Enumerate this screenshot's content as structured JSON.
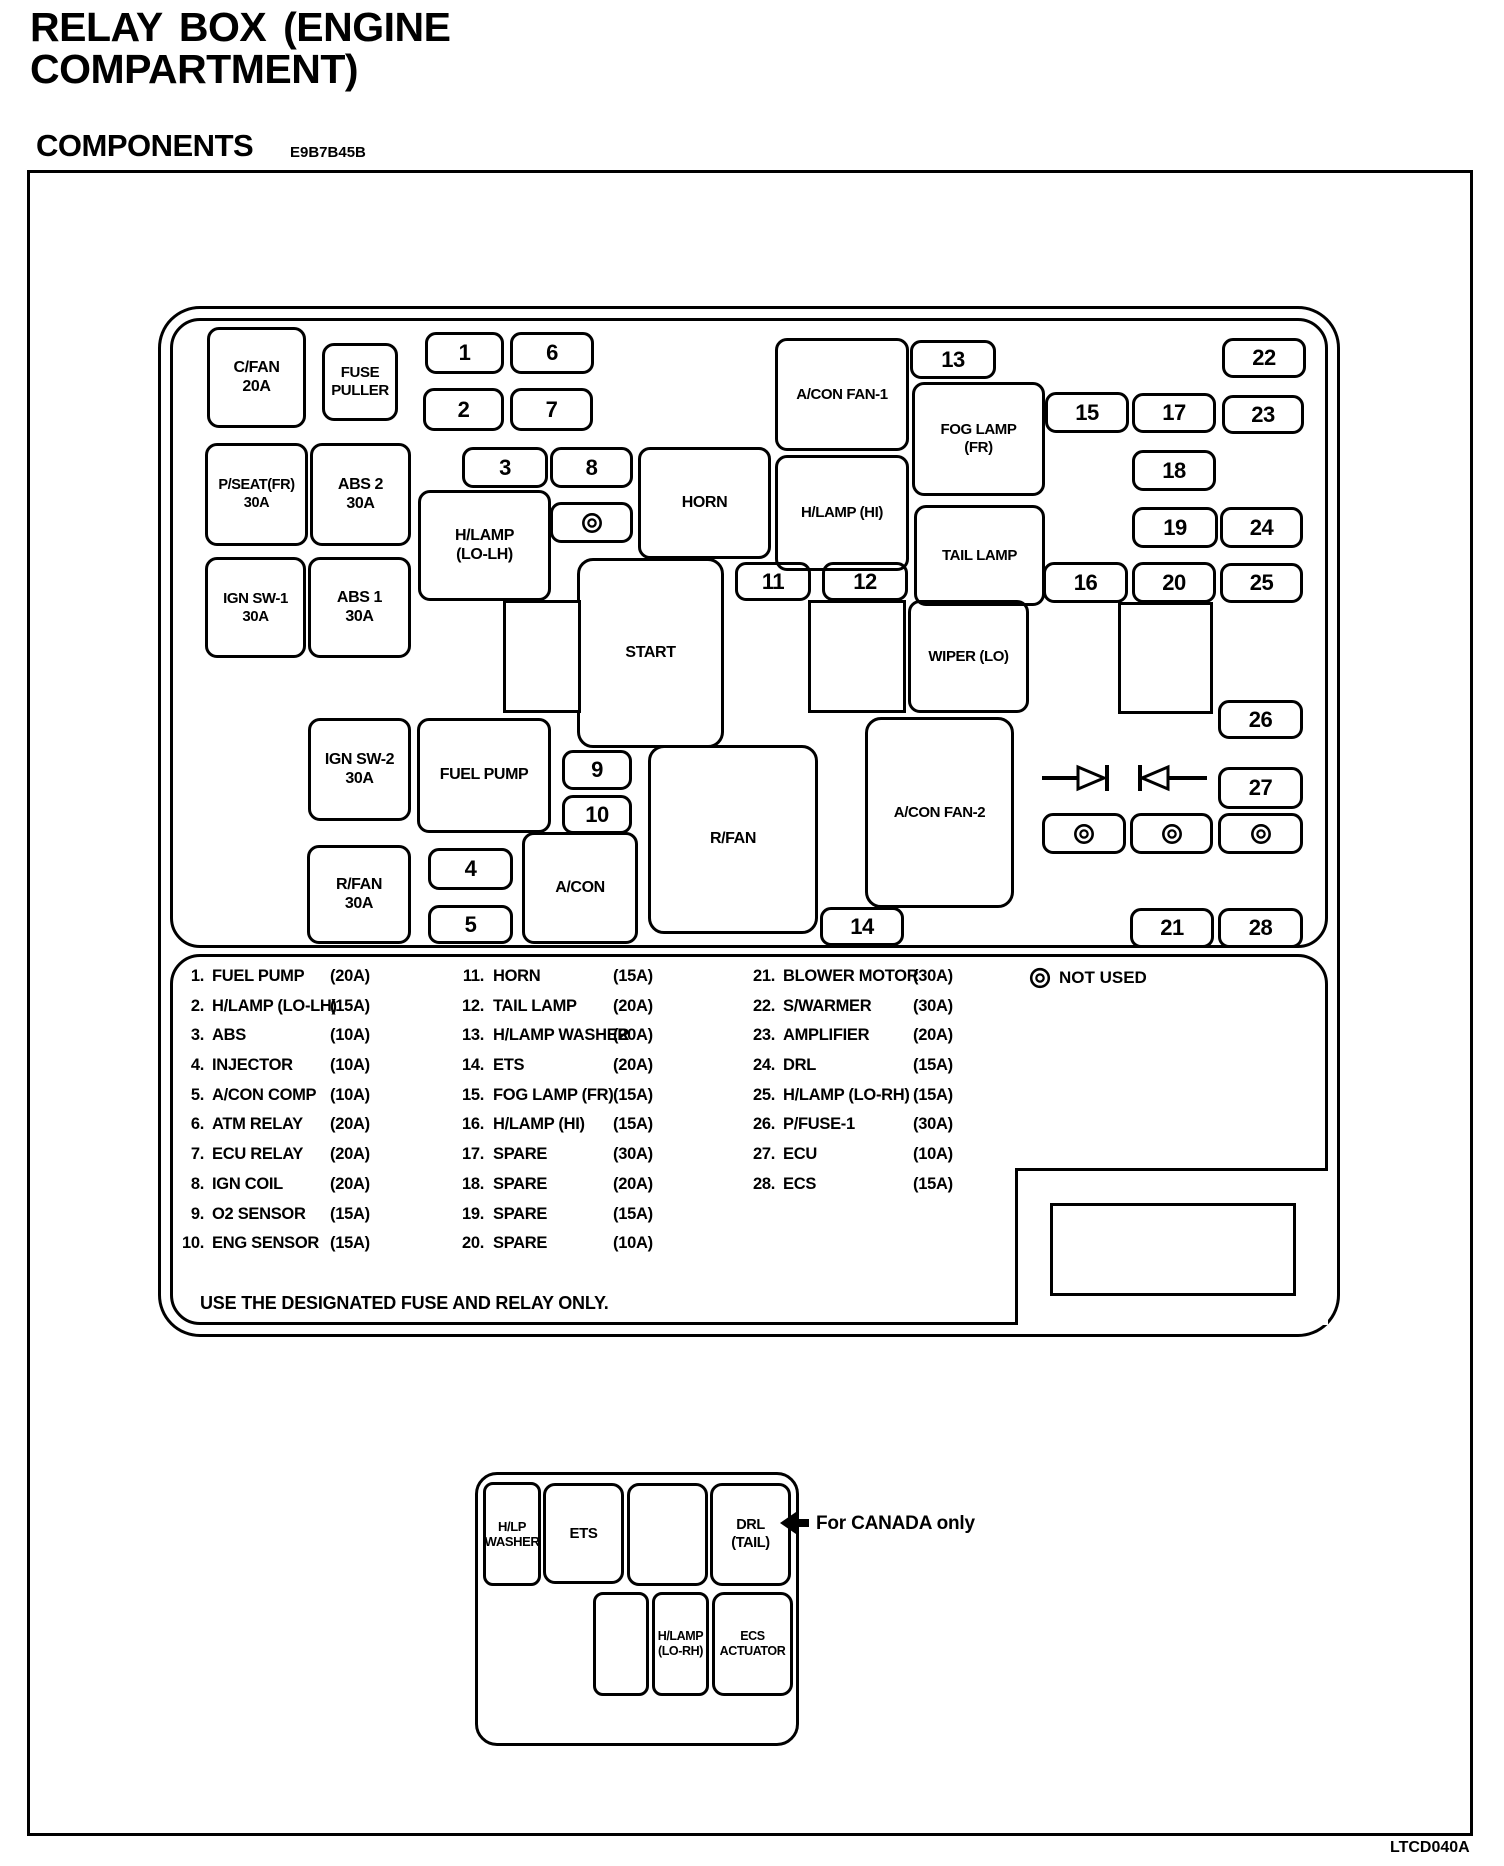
{
  "header": {
    "title": "RELAY BOX (ENGINE\nCOMPARTMENT)",
    "section": "COMPONENTS",
    "section_code": "E9B7B45B",
    "figure_code": "LTCD040A"
  },
  "diagram": {
    "relays": {
      "cfan": "C/FAN\n20A",
      "fuse_puller": "FUSE\nPULLER",
      "pseat_fr": "P/SEAT(FR)\n30A",
      "abs2": "ABS 2\n30A",
      "ign_sw1": "IGN SW-1\n30A",
      "abs1": "ABS 1\n30A",
      "hlamp_lo_lh": "H/LAMP\n(LO-LH)",
      "horn": "HORN",
      "acon_fan1": "A/CON FAN-1",
      "hlamp_hi": "H/LAMP (HI)",
      "fog_lamp_fr": "FOG LAMP\n(FR)",
      "tail_lamp": "TAIL LAMP",
      "wiper_lo": "WIPER (LO)",
      "start": "START",
      "ign_sw2": "IGN SW-2\n30A",
      "fuel_pump": "FUEL PUMP",
      "rfan_30a": "R/FAN\n30A",
      "acon": "A/CON",
      "rfan": "R/FAN",
      "acon_fan2": "A/CON FAN-2"
    },
    "fuses": {
      "f1": "1",
      "f2": "2",
      "f3": "3",
      "f4": "4",
      "f5": "5",
      "f6": "6",
      "f7": "7",
      "f8": "8",
      "f9": "9",
      "f10": "10",
      "f11": "11",
      "f12": "12",
      "f13": "13",
      "f14": "14",
      "f15": "15",
      "f16": "16",
      "f17": "17",
      "f18": "18",
      "f19": "19",
      "f20": "20",
      "f21": "21",
      "f22": "22",
      "f23": "23",
      "f24": "24",
      "f25": "25",
      "f26": "26",
      "f27": "27",
      "f28": "28"
    }
  },
  "legend": {
    "col1": [
      {
        "num": "1.",
        "name": "FUEL PUMP",
        "amp": "(20A)"
      },
      {
        "num": "2.",
        "name": "H/LAMP (LO-LH)",
        "amp": "(15A)"
      },
      {
        "num": "3.",
        "name": "ABS",
        "amp": "(10A)"
      },
      {
        "num": "4.",
        "name": "INJECTOR",
        "amp": "(10A)"
      },
      {
        "num": "5.",
        "name": "A/CON COMP",
        "amp": "(10A)"
      },
      {
        "num": "6.",
        "name": "ATM RELAY",
        "amp": "(20A)"
      },
      {
        "num": "7.",
        "name": "ECU RELAY",
        "amp": "(20A)"
      },
      {
        "num": "8.",
        "name": "IGN COIL",
        "amp": "(20A)"
      },
      {
        "num": "9.",
        "name": "O2 SENSOR",
        "amp": "(15A)"
      },
      {
        "num": "10.",
        "name": "ENG SENSOR",
        "amp": "(15A)"
      }
    ],
    "col2": [
      {
        "num": "11.",
        "name": "HORN",
        "amp": "(15A)"
      },
      {
        "num": "12.",
        "name": "TAIL LAMP",
        "amp": "(20A)"
      },
      {
        "num": "13.",
        "name": "H/LAMP WASHER",
        "amp": "(20A)"
      },
      {
        "num": "14.",
        "name": "ETS",
        "amp": "(20A)"
      },
      {
        "num": "15.",
        "name": "FOG LAMP (FR)",
        "amp": "(15A)"
      },
      {
        "num": "16.",
        "name": "H/LAMP (HI)",
        "amp": "(15A)"
      },
      {
        "num": "17.",
        "name": "SPARE",
        "amp": "(30A)"
      },
      {
        "num": "18.",
        "name": "SPARE",
        "amp": "(20A)"
      },
      {
        "num": "19.",
        "name": "SPARE",
        "amp": "(15A)"
      },
      {
        "num": "20.",
        "name": "SPARE",
        "amp": "(10A)"
      }
    ],
    "col3": [
      {
        "num": "21.",
        "name": "BLOWER MOTOR",
        "amp": "(30A)"
      },
      {
        "num": "22.",
        "name": "S/WARMER",
        "amp": "(30A)"
      },
      {
        "num": "23.",
        "name": "AMPLIFIER",
        "amp": "(20A)"
      },
      {
        "num": "24.",
        "name": "DRL",
        "amp": "(15A)"
      },
      {
        "num": "25.",
        "name": "H/LAMP (LO-RH)",
        "amp": "(15A)"
      },
      {
        "num": "26.",
        "name": "P/FUSE-1",
        "amp": "(30A)"
      },
      {
        "num": "27.",
        "name": "ECU",
        "amp": "(10A)"
      },
      {
        "num": "28.",
        "name": "ECS",
        "amp": "(15A)"
      }
    ],
    "not_used_label": "NOT USED",
    "footer": "USE THE DESIGNATED FUSE AND RELAY ONLY."
  },
  "canada": {
    "hlp_washer": "H/LP\nWASHER",
    "ets": "ETS",
    "drl_tail": "DRL\n(TAIL)",
    "hlamp_lo_rh": "H/LAMP\n(LO-RH)",
    "ecs_actuator": "ECS\nACTUATOR",
    "note": "For CANADA only"
  }
}
